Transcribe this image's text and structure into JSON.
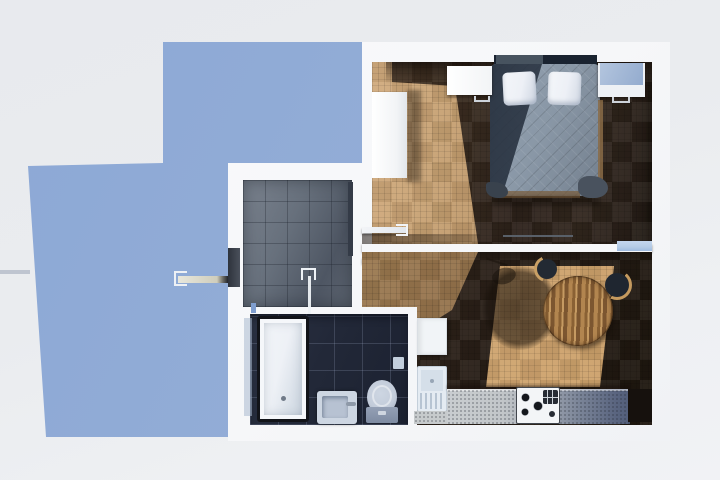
{
  "scene": {
    "description": "Top-down 3D render of a one-bedroom apartment floor plan, sunlight from upper right casting a blue building shadow to the lower left",
    "rooms": {
      "bedroom": {
        "label": "Bedroom"
      },
      "living_dining": {
        "label": "Living / dining room"
      },
      "kitchen": {
        "label": "Kitchen area"
      },
      "entry_hall": {
        "label": "Tiled entry hall with shower"
      },
      "bathroom": {
        "label": "Bathroom"
      }
    },
    "furniture": {
      "bed": {
        "label": "Double bed with gray quilted duvet"
      },
      "pillow": {
        "label": "White pillow"
      },
      "nightstand_left": {
        "label": "Left nightstand"
      },
      "nightstand_right": {
        "label": "Right nightstand"
      },
      "wardrobe": {
        "label": "White wardrobe"
      },
      "dining_table": {
        "label": "Round wooden dining table"
      },
      "chair_upper": {
        "label": "Dark chair with wood rim"
      },
      "chair_right": {
        "label": "Rattan-rimmed chair"
      },
      "kitchen_counter": {
        "label": "Kitchen counter"
      },
      "stove": {
        "label": "Gas cooktop with four burners"
      },
      "washing_machine": {
        "label": "White appliance"
      },
      "radiator": {
        "label": "Slatted white unit"
      },
      "bathtub": {
        "label": "Bathtub"
      },
      "sink": {
        "label": "Bathroom sink"
      },
      "toilet": {
        "label": "Toilet"
      },
      "entry_door": {
        "label": "Entry door swung open"
      },
      "bedroom_door": {
        "label": "Bedroom door swung open"
      },
      "living_door": {
        "label": "Living room door swung open"
      },
      "shower_door": {
        "label": "Glass shower door with handle"
      },
      "glass_panel": {
        "label": "Glass section of partition wall"
      }
    },
    "colors": {
      "bg": "#eaecef",
      "shadow-blue": "#8ca8d5",
      "shadow-blue2": "#9db2da",
      "wall": "#f6f7f9",
      "wood-light": "#c29b6d",
      "wood-dark": "#31261d",
      "tile-hall": "#67707c",
      "tile-bath": "#222838",
      "duvet": "#8997a6",
      "duvet-shadow": "#323c49",
      "headboard": "#1a2330",
      "pillow": "#edf0f6",
      "furniture-white": "#f2f4f6",
      "table-wood": "#a87c49",
      "chair-dark": "#232a33",
      "chair-gold": "#c9a065",
      "counter-light": "#c9cdd0",
      "counter-dark": "#525e7a",
      "stove-white": "#f3f5f7",
      "tub-white": "#eef1f6",
      "fixture-blue": "#cdd6e2",
      "glass-blue": "#b5cbe6"
    }
  }
}
